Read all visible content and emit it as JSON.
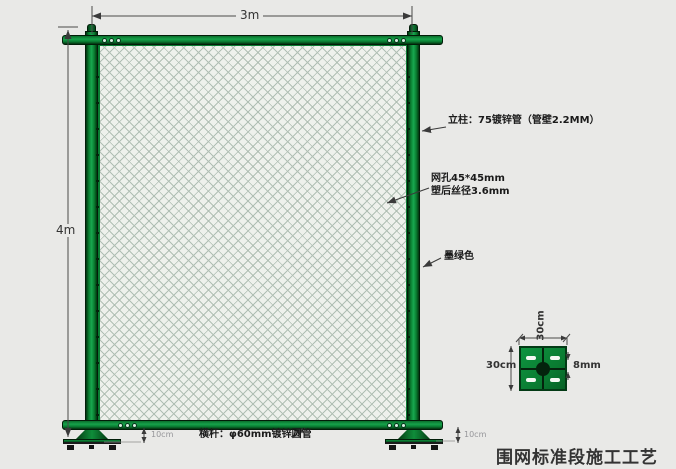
{
  "title": "围网标准段施工工艺",
  "fence": {
    "width_label": "3m",
    "height_label": "4m",
    "ground_gap_left": "10cm",
    "ground_gap_right": "10cm"
  },
  "annotations": {
    "post": "立柱：75镀锌管（管壁2.2MM）",
    "mesh_line1": "网孔45*45mm",
    "mesh_line2": "塑后丝径3.6mm",
    "mesh_color": "墨绿色",
    "rail": "横杆：φ60mm镀锌圆管"
  },
  "base_plate_detail": {
    "width_label": "30cm",
    "height_label": "30cm",
    "hole_label": "8mm"
  },
  "colors": {
    "fence_green": "#0a7c32",
    "fence_green_light": "#18a850",
    "fence_green_dark": "#02340f",
    "background": "#e9e9e7",
    "mesh_wire": "#b0bfb4",
    "mesh_background": "#eef1ec"
  }
}
